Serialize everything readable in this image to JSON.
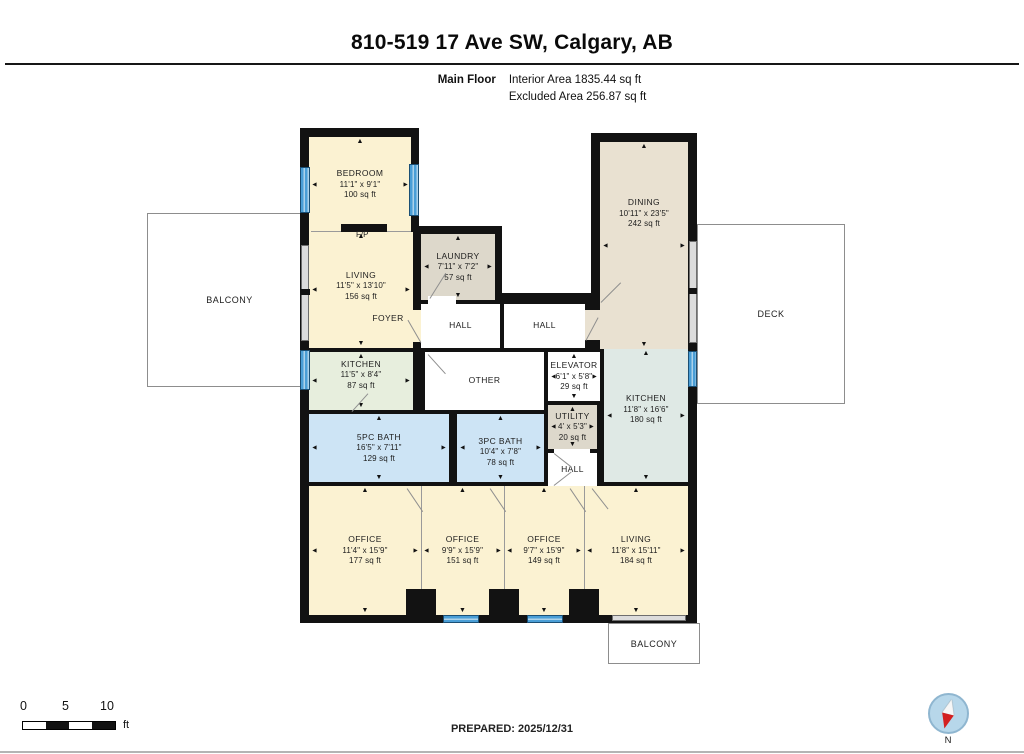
{
  "header": {
    "title": "810-519 17 Ave SW, Calgary, AB",
    "floor_label": "Main Floor",
    "area_lines": [
      "Interior Area 1835.44 sq ft",
      "Excluded Area 256.87 sq ft"
    ]
  },
  "rooms": [
    {
      "id": "bedroom",
      "name": "BEDROOM",
      "dims": "11'1\" x 9'1\"",
      "area": "100 sq ft"
    },
    {
      "id": "living_left",
      "name": "LIVING",
      "dims": "11'5\" x 13'10\"",
      "area": "156 sq ft"
    },
    {
      "id": "kitchen_left",
      "name": "KITCHEN",
      "dims": "11'5\" x 8'4\"",
      "area": "87 sq ft"
    },
    {
      "id": "laundry",
      "name": "LAUNDRY",
      "dims": "7'11\" x 7'2\"",
      "area": "57 sq ft"
    },
    {
      "id": "foyer_left",
      "name": "FOYER"
    },
    {
      "id": "hall1",
      "name": "HALL"
    },
    {
      "id": "hall2",
      "name": "HALL"
    },
    {
      "id": "foyer_right",
      "name": "FOYER"
    },
    {
      "id": "other",
      "name": "OTHER"
    },
    {
      "id": "elevator",
      "name": "ELEVATOR",
      "dims": "6'1\" x 5'8\"",
      "area": "29 sq ft"
    },
    {
      "id": "utility",
      "name": "UTILITY",
      "dims": "4' x 5'3\"",
      "area": "20 sq ft"
    },
    {
      "id": "hall3",
      "name": "HALL"
    },
    {
      "id": "dining",
      "name": "DINING",
      "dims": "10'11\" x 23'5\"",
      "area": "242 sq ft"
    },
    {
      "id": "kitchen_right",
      "name": "KITCHEN",
      "dims": "11'8\" x 16'6\"",
      "area": "180 sq ft"
    },
    {
      "id": "bath5",
      "name": "5PC BATH",
      "dims": "16'5\" x 7'11\"",
      "area": "129 sq ft"
    },
    {
      "id": "bath3",
      "name": "3PC BATH",
      "dims": "10'4\" x 7'8\"",
      "area": "78 sq ft"
    },
    {
      "id": "office1",
      "name": "OFFICE",
      "dims": "11'4\" x 15'9\"",
      "area": "177 sq ft"
    },
    {
      "id": "office2",
      "name": "OFFICE",
      "dims": "9'9\" x 15'9\"",
      "area": "151 sq ft"
    },
    {
      "id": "office3",
      "name": "OFFICE",
      "dims": "9'7\" x 15'9\"",
      "area": "149 sq ft"
    },
    {
      "id": "living_right",
      "name": "LIVING",
      "dims": "11'8\" x 15'11\"",
      "area": "184 sq ft"
    }
  ],
  "outdoor": {
    "balcony_left": "BALCONY",
    "deck": "DECK",
    "balcony_bottom": "BALCONY"
  },
  "plan": {
    "fireplace_label": "F/P"
  },
  "scale_bar": {
    "ticks": [
      "0",
      "5",
      "10"
    ],
    "unit": "ft"
  },
  "footer": {
    "prepared": "PREPARED: 2025/12/31"
  },
  "compass": {
    "north_label": "N"
  },
  "colors": {
    "cream": "#fbf2d2",
    "tan": "#e9e1d1",
    "gray": "#ddd8cb",
    "green": "#e7eedd",
    "teal": "#dfe9e5",
    "blue": "#cde4f5",
    "window": "#4a9ed6",
    "wall": "#121212"
  }
}
